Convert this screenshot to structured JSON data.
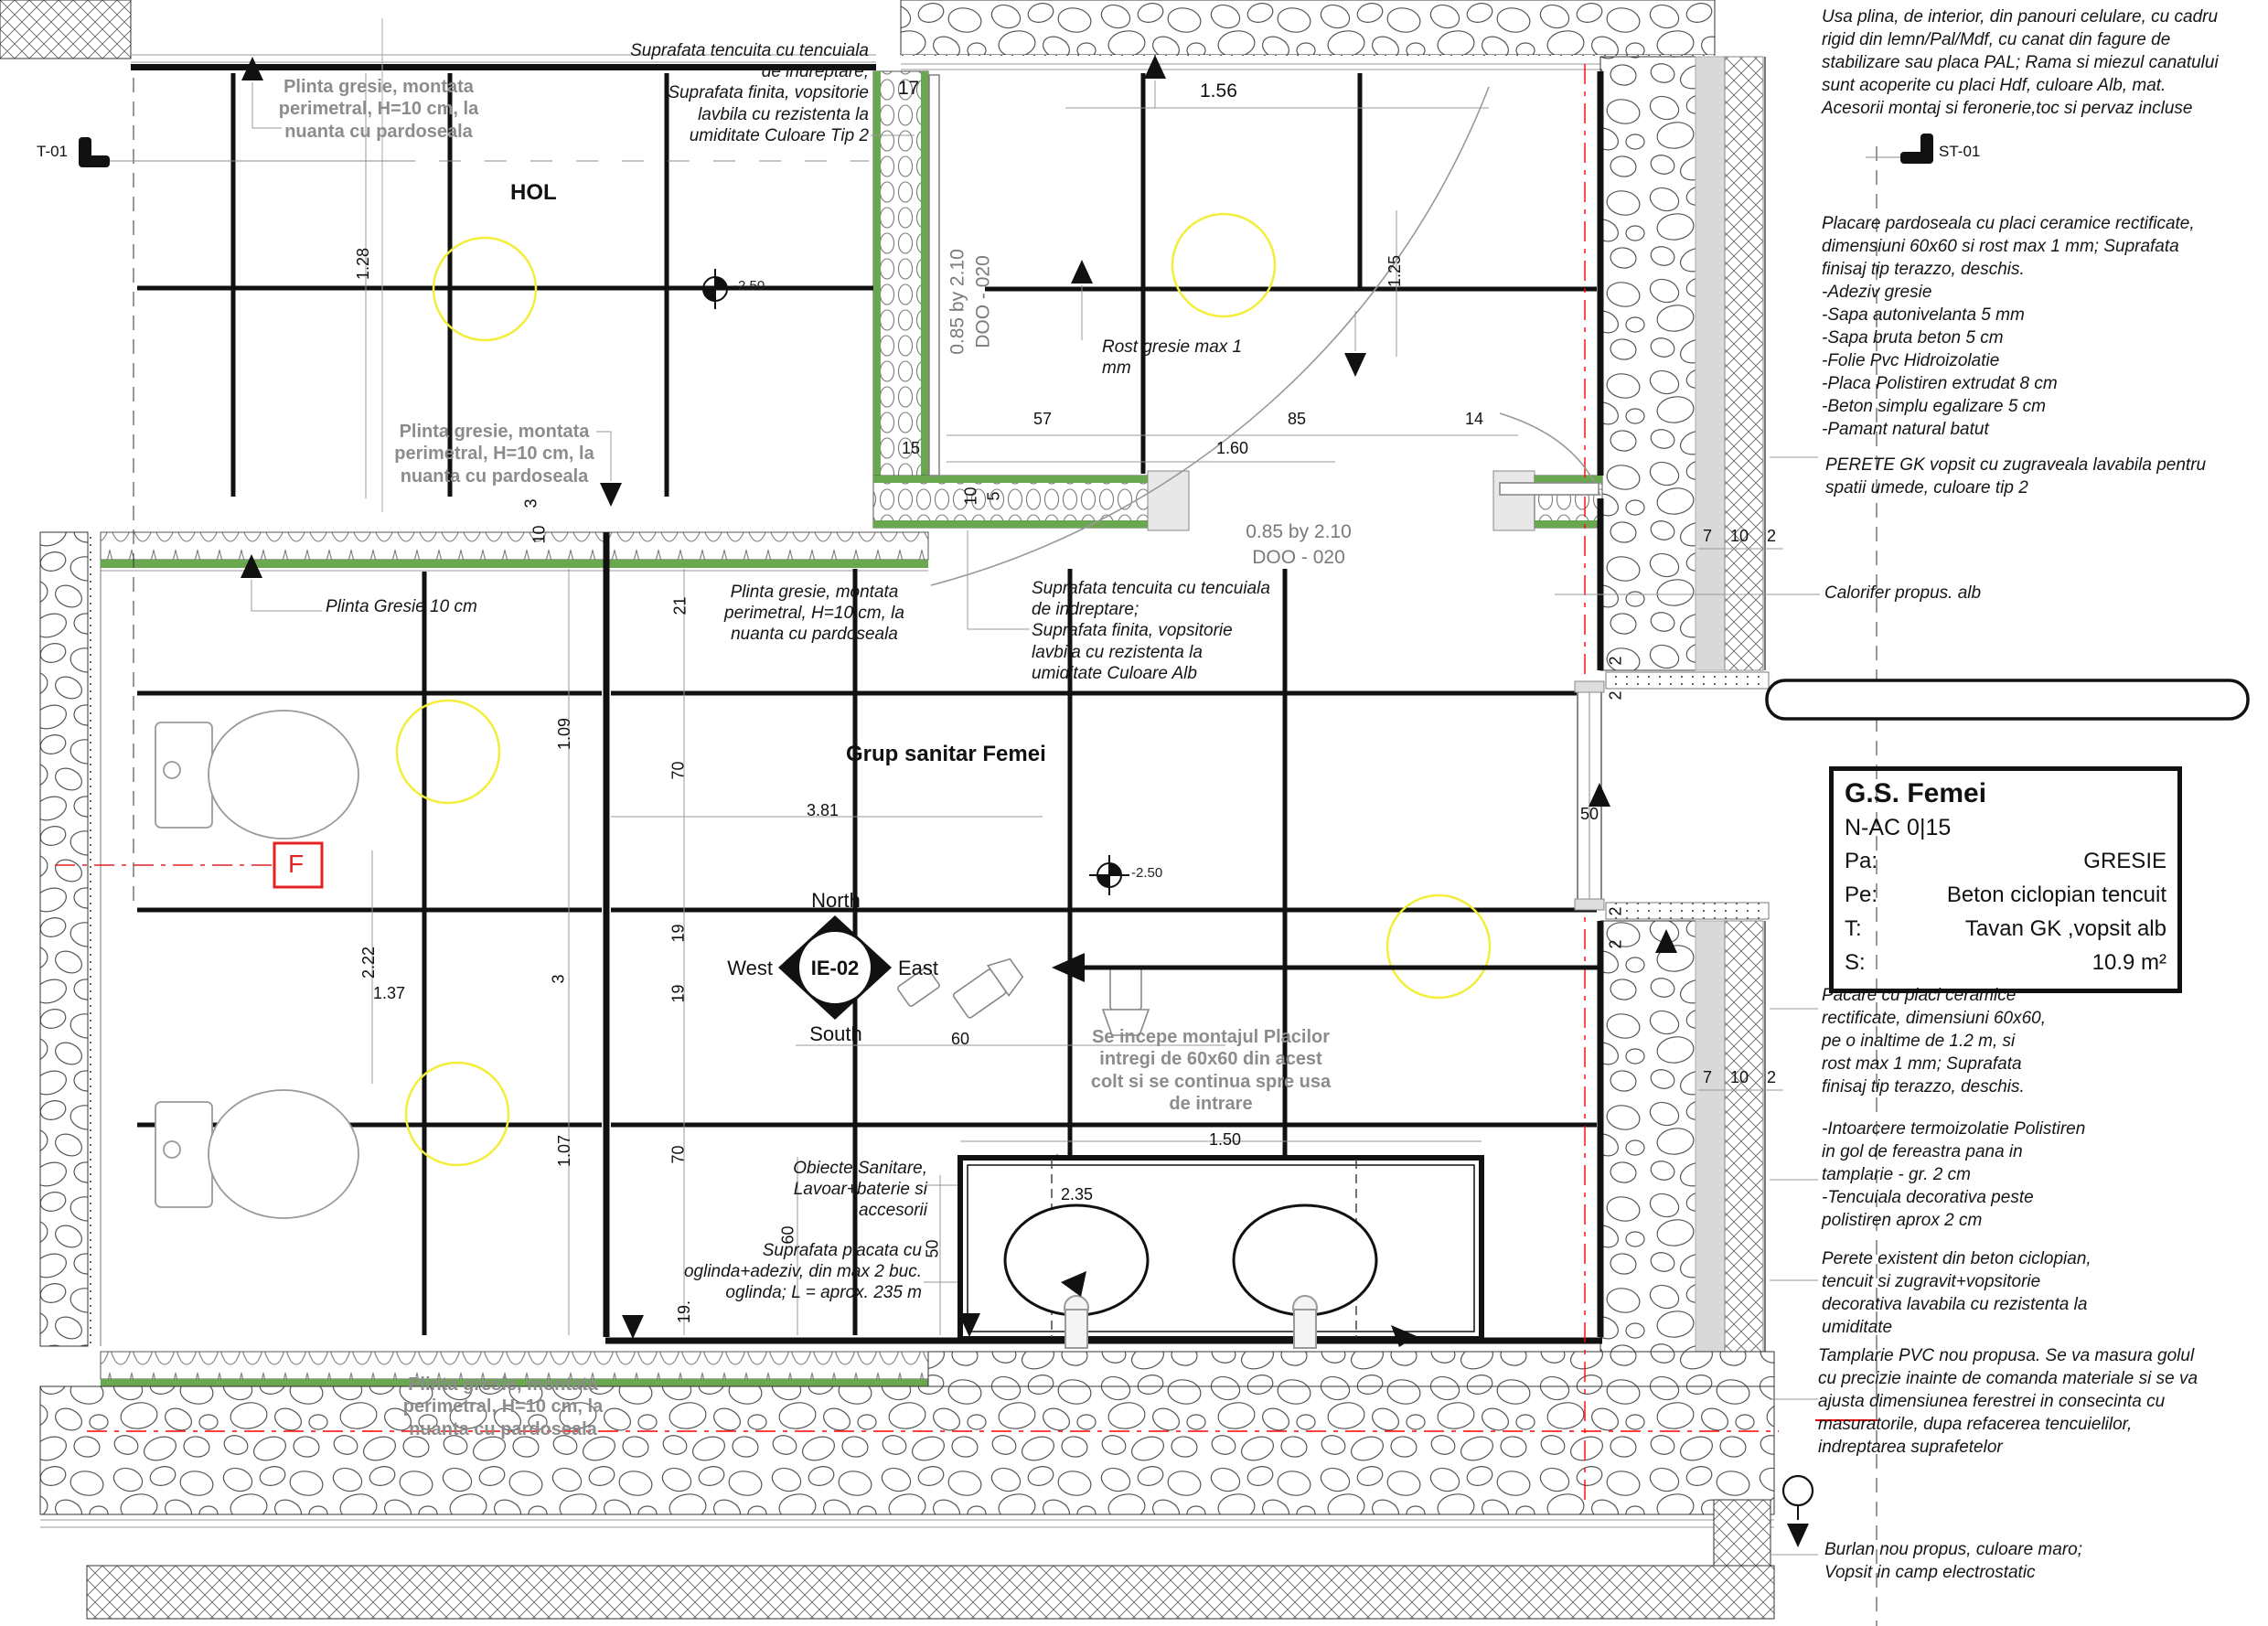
{
  "drawing": {
    "rooms": {
      "hol": "HOL",
      "main": "Grup sanitar Femei"
    },
    "levels": {
      "hol": "-2.50",
      "main": "-2.50"
    },
    "compass": {
      "id": "IE-02",
      "north": "North",
      "south": "South",
      "east": "East",
      "west": "West"
    },
    "markers": {
      "t01": "T-01",
      "st01": "ST-01",
      "section": "F"
    },
    "doors": {
      "door1": {
        "size": "0.85 by 2.10",
        "code": "DOO - 020"
      },
      "door2": {
        "size": "0.85 by 2.10",
        "code": "DOO - 020"
      }
    },
    "notes": {
      "plinta1": "Plinta gresie, montata\nperimetral, H=10 cm, la\nnuanta cu pardoseala",
      "plinta2": "Plinta gresie, montata\nperimetral, H=10 cm, la\nnuanta cu pardoseala",
      "plinta3": "Plinta gresie, montata\nperimetral, H=10 cm, la\nnuanta cu pardoseala",
      "plinta_italic": "Plinta gresie, montata\nperimetral, H=10 cm, la\nnuanta cu pardoseala",
      "plinta_gresie10": "Plinta Gresie 10 cm",
      "suprafata_tip2": "Suprafata tencuita cu tencuiala\nde indreptare;\nSuprafata finita, vopsitorie\nlavbila cu rezistenta la\numiditate Culoare Tip 2",
      "suprafata_alb": "Suprafata tencuita cu tencuiala\nde indreptare;\nSuprafata finita, vopsitorie\nlavbila cu rezistenta la\numiditate Culoare Alb",
      "rost": "Rost gresie max 1\nmm",
      "montaj": "Se incepe montajul Placilor\nintregi de 60x60 din acest\ncolt si se continua spre usa\nde intrare",
      "obiecte": "Obiecte Sanitare,\nLavoar+baterie si\naccesorii",
      "oglinda": "Suprafata placata cu\noglinda+adeziv, din max 2 buc.\noglinda; L = aprox. 235 m",
      "calorifer": "Calorifer propus. alb"
    },
    "right_notes": {
      "usa": "Usa plina, de interior, din panouri celulare, cu cadru\nrigid din lemn/Pal/Mdf, cu canat din fagure de\nstabilizare sau placa PAL; Rama si miezul canatului\nsunt acoperite cu placi Hdf, culoare Alb, mat.\nAcesorii montaj si feronerie,toc si pervaz incluse",
      "placare": "Placare pardoseala cu placi ceramice rectificate,\ndimensiuni 60x60 si rost max 1 mm; Suprafata\nfinisaj tip terazzo, deschis.\n-Adeziv gresie\n-Sapa autonivelanta 5 mm\n-Sapa bruta beton 5 cm\n-Folie Pvc Hidroizolatie\n-Placa Polistiren extrudat 8 cm\n-Beton simplu egalizare 5 cm\n-Pamant natural batut",
      "perete_gk": "PERETE GK  vopsit cu zugraveala lavabila pentru\nspatii umede, culoare tip 2",
      "pacare": "Pacare cu placi ceramice\nrectificate, dimensiuni 60x60,\npe o inaltime de 1.2 m, si\nrost max 1 mm; Suprafata\nfinisaj tip terazzo, deschis.",
      "intoarcere": "-Intoarcere termoizolatie Polistiren\nin gol de fereastra pana in\ntamplarie - gr. 2 cm\n-Tencuiala decorativa peste\npolistiren aprox 2 cm",
      "perete_existent": "Perete existent din beton ciclopian,\ntencuit si zugravit+vopsitorie\ndecorativa lavabila cu rezistenta la\numiditate",
      "tamplarie": "Tamplarie PVC nou propusa. Se va masura golul\ncu precizie inainte de comanda materiale si se va\najusta dimensiunea ferestrei in consecinta cu\nmasuratorile, dupa refacerea tencuielilor,\nindreptarea suprafetelor",
      "burlan": "Burlan nou propus, culoare maro;\nVopsit in camp electrostatic"
    },
    "info_box": {
      "title": "G.S. Femei",
      "code": "N-AC 0|15",
      "rows": [
        {
          "k": "Pa:",
          "v": "GRESIE"
        },
        {
          "k": "Pe:",
          "v": "Beton ciclopian tencuit"
        },
        {
          "k": "T:",
          "v": "Tavan GK ,vopsit alb"
        },
        {
          "k": "S:",
          "v": "10.9 m²"
        }
      ]
    },
    "dims": {
      "d156": "1.56",
      "d17": "17",
      "d128": "1.28",
      "d125": "1.25",
      "d57": "57",
      "d85": "85",
      "d14": "14",
      "d160": "1.60",
      "d15": "15",
      "d10a": "10",
      "d5a": "5",
      "d3a": "3",
      "d10b": "10",
      "d21": "21",
      "d109": "1.09",
      "d70a": "70",
      "d381": "3.81",
      "d19a": "19",
      "d19b": "19",
      "d222": "2.22",
      "d137": "1.37",
      "d3b": "3",
      "d60a": "60",
      "d70b": "70",
      "d107": "1.07",
      "d60b": "60",
      "d50a": "50",
      "d19c": "19.",
      "d150": "1.50",
      "d235": "2.35",
      "d50w": "50",
      "d2a": "2",
      "d2b": "2",
      "d2c": "2",
      "d2d": "2",
      "d7a": "7",
      "d10c": "10",
      "d2e": "2",
      "d7b": "7",
      "d10d": "10",
      "d2f": "2"
    }
  }
}
